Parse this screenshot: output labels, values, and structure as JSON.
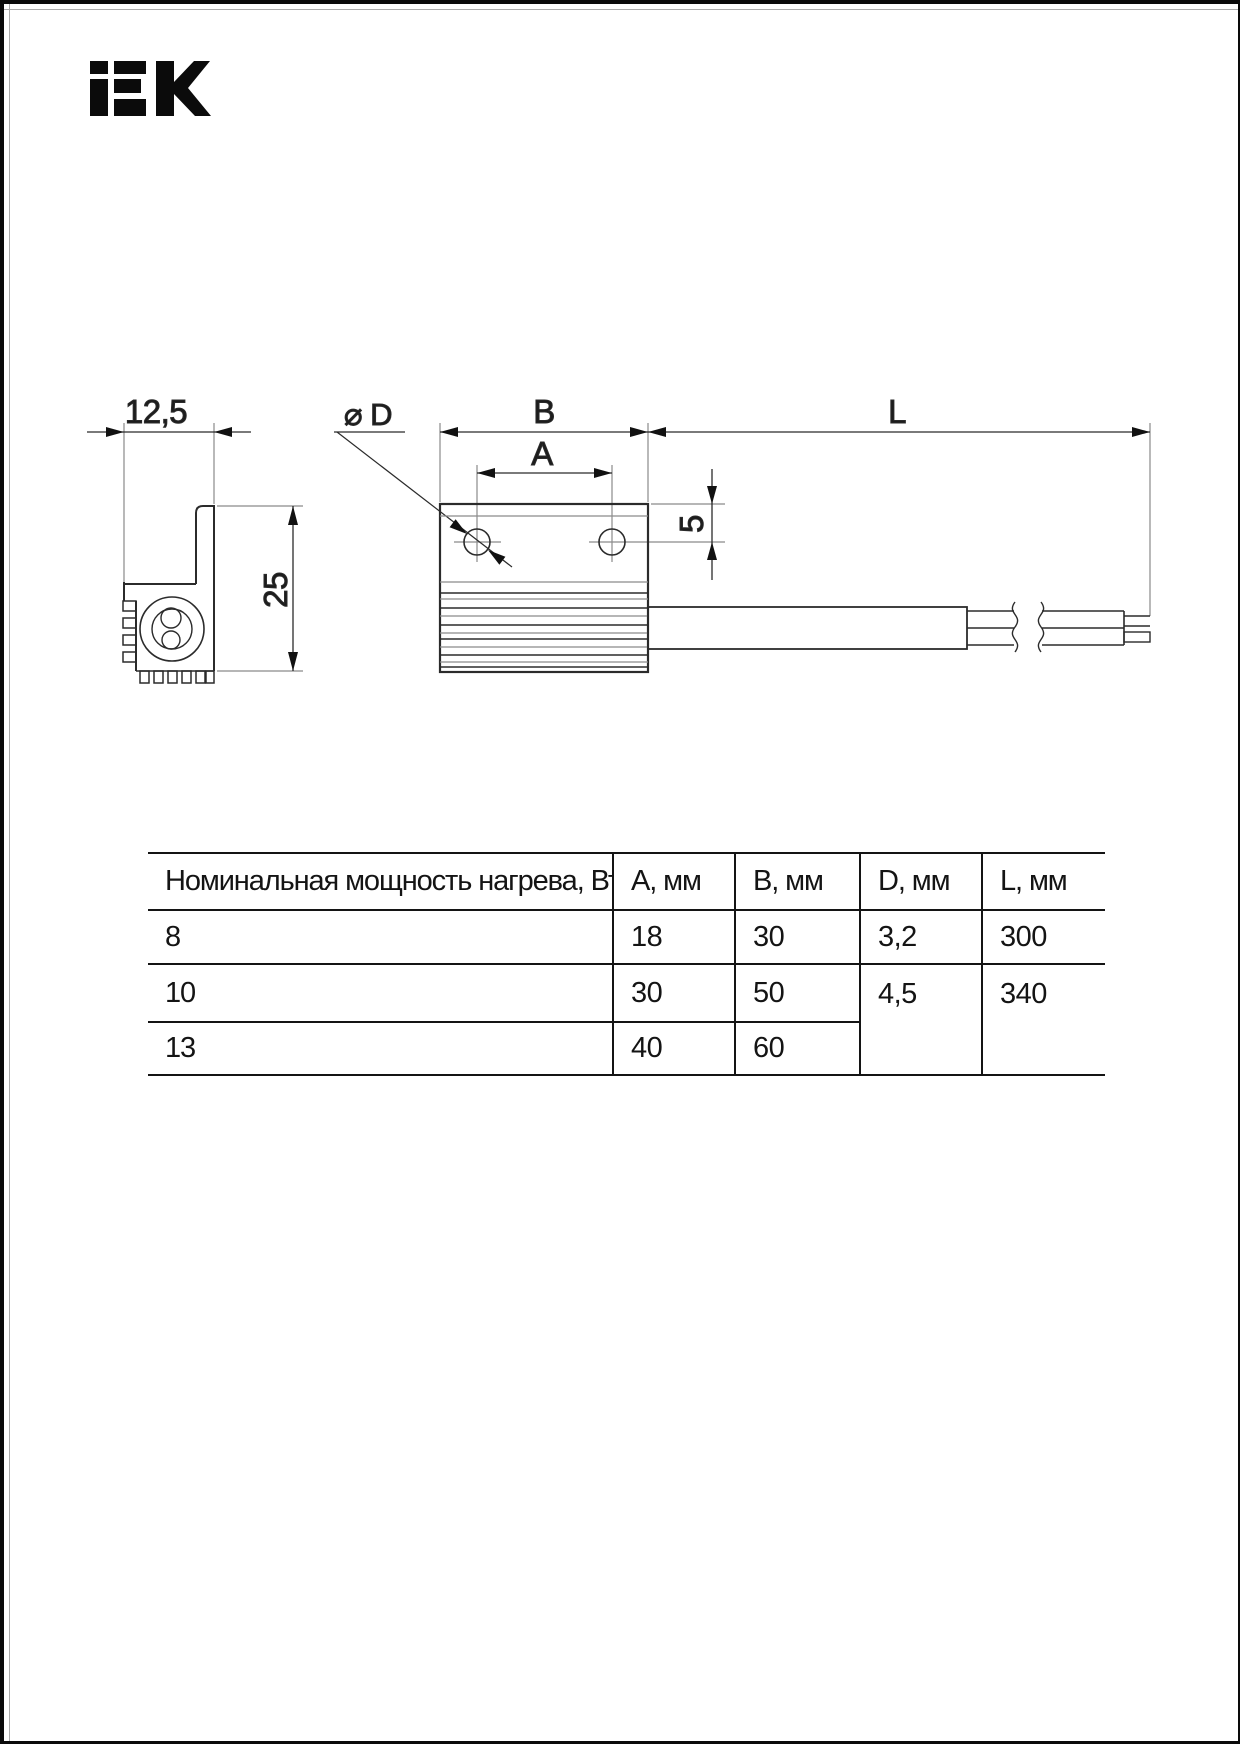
{
  "page": {
    "brand": "IEK"
  },
  "drawing": {
    "side_view": {
      "depth_label": "12,5",
      "height_label": "25"
    },
    "top_view": {
      "diameter_label": "⌀ D",
      "width_label": "B",
      "hole_spacing_label": "A",
      "hole_offset_label": "5",
      "length_label": "L"
    }
  },
  "table": {
    "headers": [
      "Номинальная мощность нагрева, Вт",
      "A, мм",
      "B, мм",
      "D, мм",
      "L, мм"
    ],
    "rows": [
      {
        "power": "8",
        "a": "18",
        "b": "30",
        "d": "3,2",
        "l": "300"
      },
      {
        "power": "10",
        "a": "30",
        "b": "50",
        "d": "4,5",
        "l": "340"
      },
      {
        "power": "13",
        "a": "40",
        "b": "60"
      }
    ]
  }
}
